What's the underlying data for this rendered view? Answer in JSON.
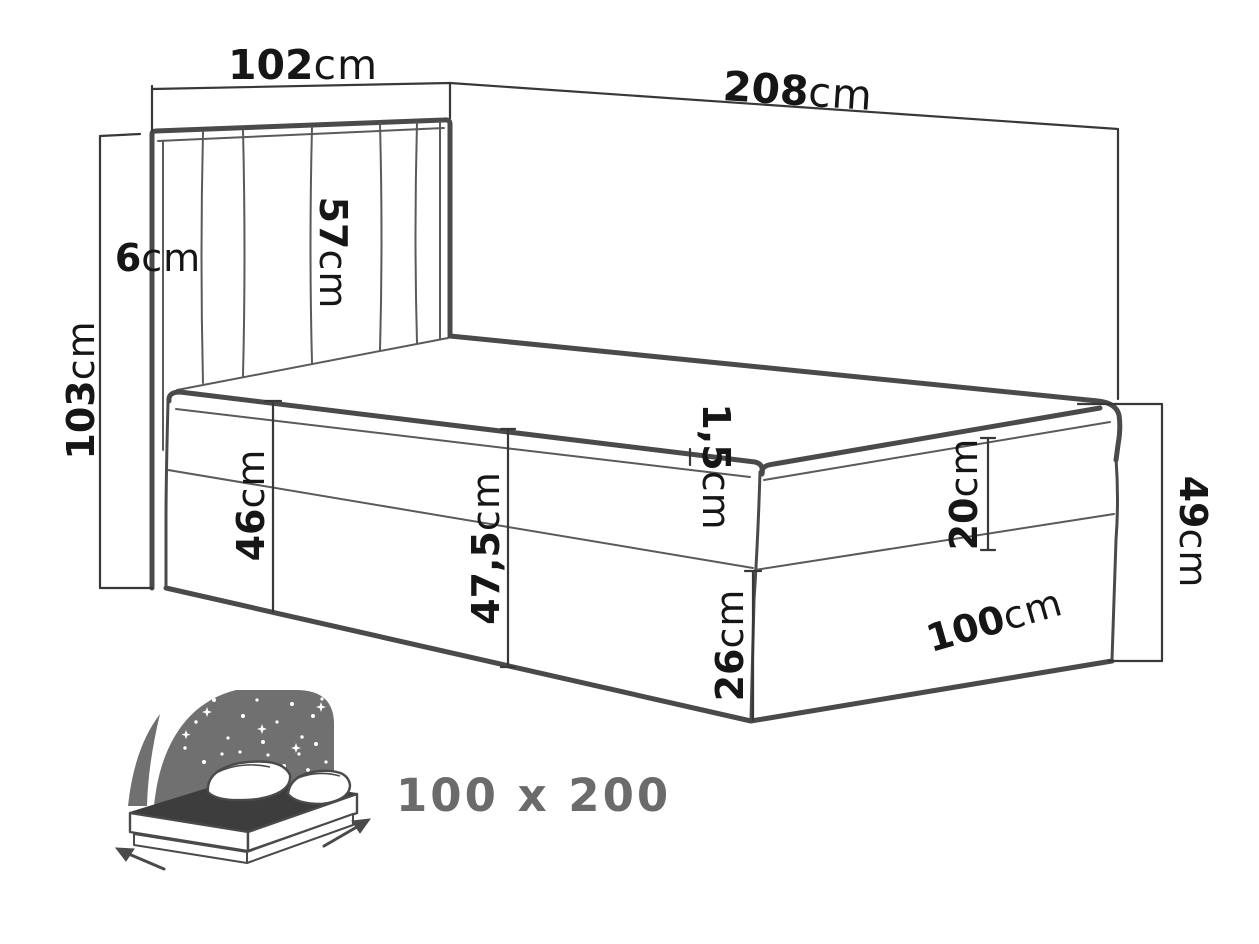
{
  "dims": {
    "headboard_width": {
      "value": "102",
      "unit": "cm"
    },
    "bed_length": {
      "value": "208",
      "unit": "cm"
    },
    "headboard_height": {
      "value": "103",
      "unit": "cm"
    },
    "headboard_depth": {
      "value": "6",
      "unit": "cm"
    },
    "headboard_panel_height": {
      "value": "57",
      "unit": "cm"
    },
    "base_height_head": {
      "value": "46",
      "unit": "cm"
    },
    "side_height_center": {
      "value": "47,5",
      "unit": "cm"
    },
    "topper_thickness": {
      "value": "1,5",
      "unit": "cm"
    },
    "mattress_height": {
      "value": "20",
      "unit": "cm"
    },
    "foot_height_total": {
      "value": "49",
      "unit": "cm"
    },
    "foot_base_height": {
      "value": "26",
      "unit": "cm"
    },
    "bed_width_foot": {
      "value": "100",
      "unit": "cm"
    }
  },
  "footer": {
    "size_label": "100 x 200"
  },
  "colors": {
    "outline": "#4a4a4a",
    "dim_line": "#383838",
    "label_text": "#161616",
    "muted_gray": "#6b6b6b",
    "icon_gray": "#707070",
    "icon_mattress_top": "#3d3d3d",
    "background": "#ffffff"
  }
}
